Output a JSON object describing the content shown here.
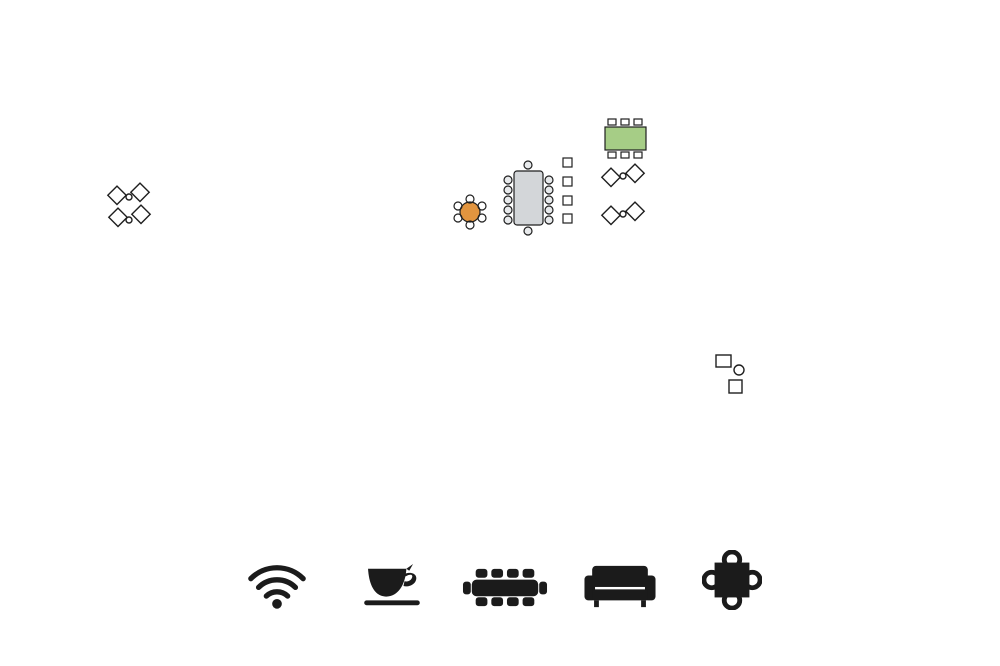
{
  "logo": {
    "name": "network-dots-logo",
    "color": "#1F9AD7"
  },
  "floorplan": {
    "wall_color": "#1a1a1a",
    "room_label_color": "#3f3f3f",
    "amenity_colors": {
      "lounge": "#55BDE8",
      "break_area": "#A6CD86",
      "conference_room": "#9EA3A8",
      "huddle_room": "#E2953F"
    },
    "zones": [
      {
        "name": "lounge-upper-left",
        "amenity": "lounge",
        "x": 107,
        "y": 182,
        "w": 46,
        "h": 71
      },
      {
        "name": "break-area",
        "amenity": "break_area",
        "x": 560,
        "y": 112,
        "w": 90,
        "h": 120
      },
      {
        "name": "conference-room",
        "amenity": "conference_room",
        "x": 496,
        "y": 153,
        "w": 64,
        "h": 79
      },
      {
        "name": "lounge-center",
        "amenity": "lounge",
        "x": 598,
        "y": 160,
        "w": 50,
        "h": 72
      },
      {
        "name": "huddle-room",
        "amenity": "huddle_room",
        "x": 445,
        "y": 190,
        "w": 49,
        "h": 42
      },
      {
        "name": "lounge-lower",
        "amenity": "lounge",
        "x": 694,
        "y": 352,
        "w": 54,
        "h": 58
      }
    ],
    "rooms": [
      {
        "label": "280",
        "x": 185,
        "y": 137
      },
      {
        "label": "270",
        "x": 268,
        "y": 137
      },
      {
        "label": "260",
        "x": 366,
        "y": 137
      },
      {
        "label": "285",
        "x": 168,
        "y": 276
      },
      {
        "label": "290",
        "x": 168,
        "y": 321
      },
      {
        "label": "200",
        "x": 355,
        "y": 374
      },
      {
        "label": "252",
        "x": 452,
        "y": 71
      },
      {
        "label": "250",
        "x": 495,
        "y": 71
      },
      {
        "label": "248",
        "x": 538,
        "y": 71
      },
      {
        "label": "246",
        "x": 582,
        "y": 71
      },
      {
        "label": "244",
        "x": 626,
        "y": 71
      },
      {
        "label": "242",
        "x": 670,
        "y": 71
      },
      {
        "label": "240",
        "x": 716,
        "y": 71
      },
      {
        "label": "238",
        "x": 771,
        "y": 77
      },
      {
        "label": "236",
        "x": 771,
        "y": 132
      },
      {
        "label": "253",
        "x": 460,
        "y": 133
      },
      {
        "label": "251",
        "x": 491,
        "y": 133
      },
      {
        "label": "249",
        "x": 522,
        "y": 133
      },
      {
        "label": "247",
        "x": 549,
        "y": 133
      },
      {
        "label": "255",
        "x": 468,
        "y": 174
      },
      {
        "label": "245",
        "x": 651,
        "y": 126
      },
      {
        "label": "243",
        "x": 684,
        "y": 126
      },
      {
        "label": "241",
        "x": 712,
        "y": 126
      },
      {
        "label": "239",
        "x": 651,
        "y": 150
      },
      {
        "label": "237",
        "x": 684,
        "y": 150
      },
      {
        "label": "235",
        "x": 712,
        "y": 150
      },
      {
        "label": "225",
        "x": 668,
        "y": 193
      },
      {
        "label": "227",
        "x": 704,
        "y": 193
      },
      {
        "label": "229",
        "x": 741,
        "y": 193
      },
      {
        "label": "231",
        "x": 778,
        "y": 193
      },
      {
        "label": "233",
        "x": 816,
        "y": 193
      },
      {
        "label": "223",
        "x": 668,
        "y": 218
      },
      {
        "label": "221",
        "x": 704,
        "y": 218
      },
      {
        "label": "219",
        "x": 741,
        "y": 218
      },
      {
        "label": "217",
        "x": 778,
        "y": 218
      },
      {
        "label": "215",
        "x": 816,
        "y": 218
      },
      {
        "label": "218",
        "x": 881,
        "y": 173
      },
      {
        "label": "216",
        "x": 881,
        "y": 203
      },
      {
        "label": "214",
        "x": 881,
        "y": 278
      },
      {
        "label": "212",
        "x": 881,
        "y": 324
      },
      {
        "label": "210",
        "x": 881,
        "y": 371
      },
      {
        "label": "208",
        "x": 878,
        "y": 421
      },
      {
        "label": "213",
        "x": 822,
        "y": 274
      },
      {
        "label": "211",
        "x": 822,
        "y": 300
      },
      {
        "label": "209",
        "x": 822,
        "y": 341
      },
      {
        "label": "207",
        "x": 822,
        "y": 367
      },
      {
        "label": "203",
        "x": 766,
        "y": 372
      },
      {
        "label": "205",
        "x": 793,
        "y": 372
      },
      {
        "label": "202",
        "x": 727,
        "y": 429
      },
      {
        "label": "204",
        "x": 777,
        "y": 425
      },
      {
        "label": "206",
        "x": 820,
        "y": 425
      }
    ],
    "utility_labels": [
      {
        "text": "ELECT",
        "x": 710,
        "y": 312,
        "size": 6.5
      },
      {
        "text": "RICAL",
        "x": 710,
        "y": 323,
        "size": 6.5
      },
      {
        "text": "PHONE",
        "x": 743,
        "y": 301,
        "size": 6.5
      },
      {
        "text": "MECH",
        "x": 782,
        "y": 301,
        "size": 6.5
      },
      {
        "text": "OPE",
        "x": 185,
        "y": 378,
        "size": 7
      },
      {
        "text": "N",
        "x": 185,
        "y": 388,
        "size": 7
      },
      {
        "text": "DN",
        "x": 190,
        "y": 355,
        "size": 4.8
      },
      {
        "text": "UP",
        "x": 200,
        "y": 364,
        "size": 4.8
      },
      {
        "text": "OPE",
        "x": 828,
        "y": 122,
        "size": 7
      },
      {
        "text": "N",
        "x": 828,
        "y": 132,
        "size": 7
      },
      {
        "text": "UP",
        "x": 809,
        "y": 136,
        "size": 4.8
      },
      {
        "text": "DN",
        "x": 818,
        "y": 144,
        "size": 4.8
      }
    ]
  },
  "legend": {
    "items": [
      {
        "line1": "Free Wi-Fi",
        "line2": "",
        "icon": "wifi-icon",
        "circle_color": "#FFFFFF",
        "circle_border": "#1b1b1b"
      },
      {
        "line1": "Break Area",
        "line2": "Coffee Bar",
        "icon": "coffee-cup-icon",
        "circle_color": "#A6CD86",
        "circle_border": ""
      },
      {
        "line1": "Conference",
        "line2": "Room",
        "icon": "conference-table-icon",
        "circle_color": "#ACB0B3",
        "circle_border": ""
      },
      {
        "line1": "Lounge",
        "line2": "",
        "icon": "couch-icon",
        "circle_color": "#55BDE8",
        "circle_border": ""
      },
      {
        "line1": "Huddle",
        "line2": "Room",
        "icon": "round-table-icon",
        "circle_color": "#E39A43",
        "circle_border": ""
      }
    ]
  }
}
